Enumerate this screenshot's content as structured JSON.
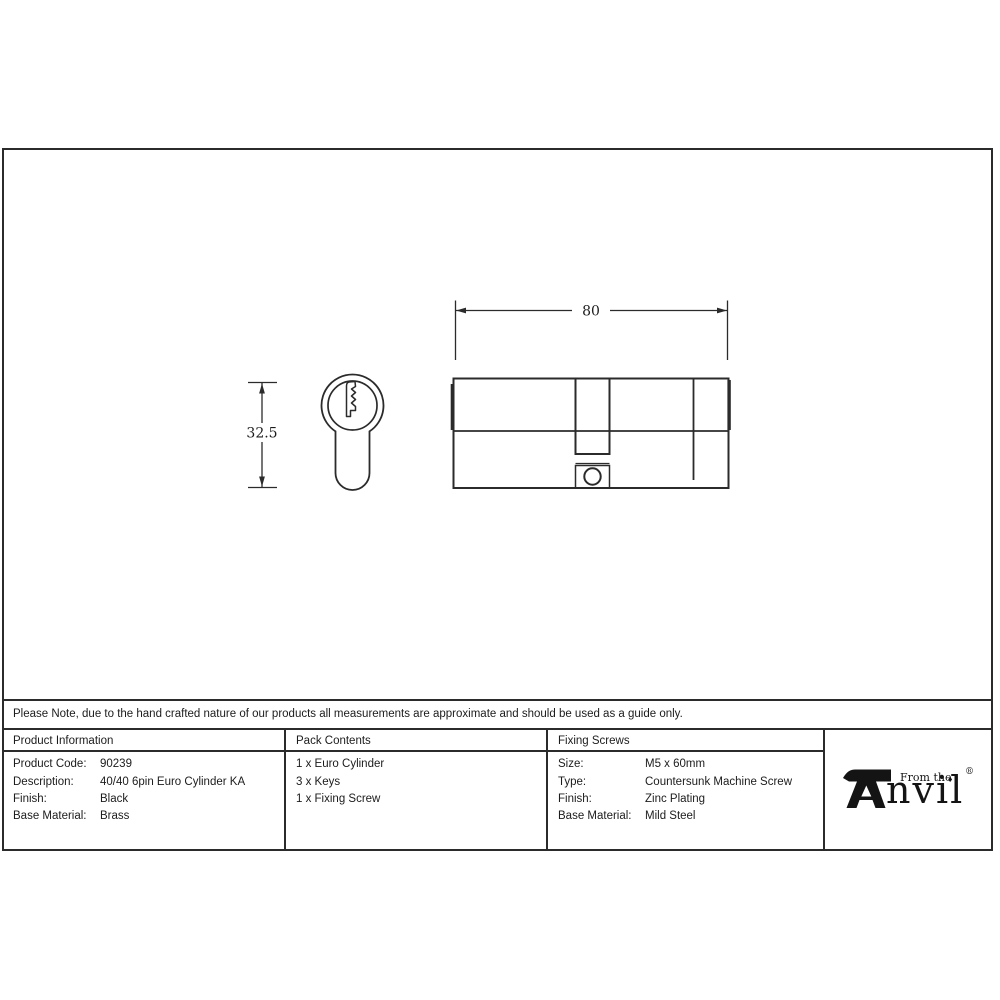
{
  "drawing": {
    "width_dim_label": "80",
    "height_dim_label": "32.5"
  },
  "note": {
    "text": "Please Note, due to the hand crafted nature of our products all measurements are approximate and should be used as a guide only."
  },
  "table": {
    "columns": [
      {
        "header": "Product Information",
        "rows": [
          {
            "label": "Product Code:",
            "value": "90239"
          },
          {
            "label": "Description:",
            "value": "40/40 6pin Euro Cylinder KA"
          },
          {
            "label": "Finish:",
            "value": "Black"
          },
          {
            "label": "Base Material:",
            "value": "Brass"
          }
        ]
      },
      {
        "header": "Pack Contents",
        "items": [
          "1 x Euro Cylinder",
          "3 x Keys",
          "1 x Fixing Screw"
        ]
      },
      {
        "header": "Fixing Screws",
        "rows": [
          {
            "label": "Size:",
            "value": "M5 x 60mm"
          },
          {
            "label": "Type:",
            "value": "Countersunk Machine Screw"
          },
          {
            "label": "Finish:",
            "value": "Zinc Plating"
          },
          {
            "label": "Base Material:",
            "value": "Mild Steel"
          }
        ]
      }
    ]
  },
  "logo": {
    "from_the": "From the",
    "diamond": "♦",
    "name_rest": "nvil",
    "registered": "®"
  },
  "colors": {
    "line": "#2b2b2b",
    "text": "#1c1c1c",
    "background": "#ffffff"
  }
}
